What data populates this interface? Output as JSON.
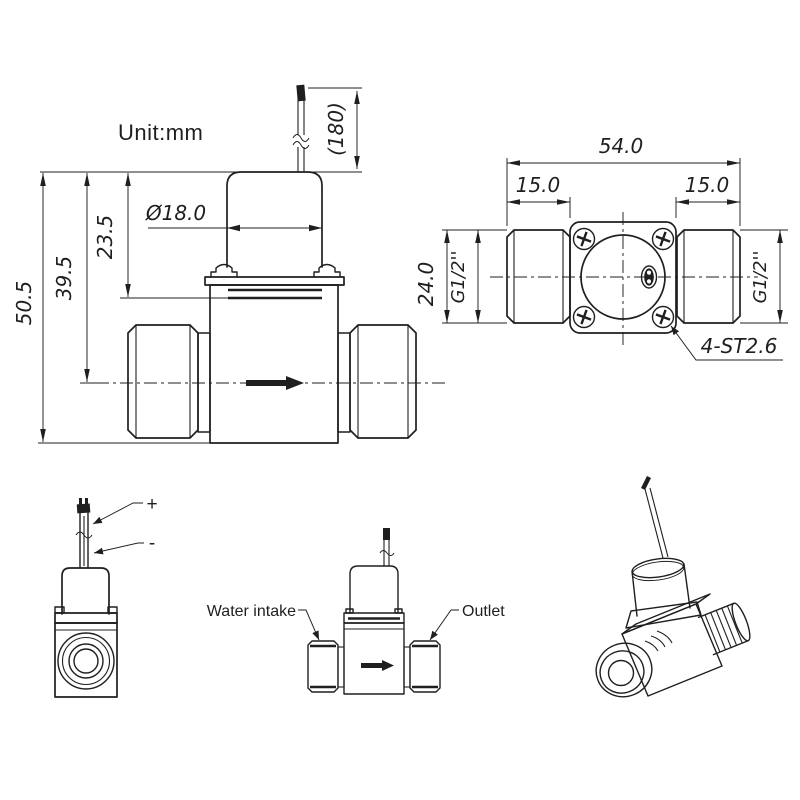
{
  "drawing": {
    "unit_label": "Unit:mm",
    "front_view": {
      "wire_length": "(180)",
      "coil_diameter": "Ø18.0",
      "height_to_body_top": "23.5",
      "height_to_centerline": "39.5",
      "total_height": "50.5"
    },
    "port_face_view": {
      "total_length": "54.0",
      "inlet_thread_length": "15.0",
      "outlet_thread_length": "15.0",
      "body_height": "24.0",
      "inlet_thread_spec": "G1/2''",
      "outlet_thread_spec": "G1/2''",
      "screw_note": "4-ST2.6"
    },
    "end_view": {
      "positive_wire": "+",
      "negative_wire": "-"
    },
    "flow_view": {
      "inlet_label": "Water intake",
      "outlet_label": "Outlet"
    },
    "colors": {
      "line": "#1f1f1f",
      "background": "#ffffff"
    }
  }
}
